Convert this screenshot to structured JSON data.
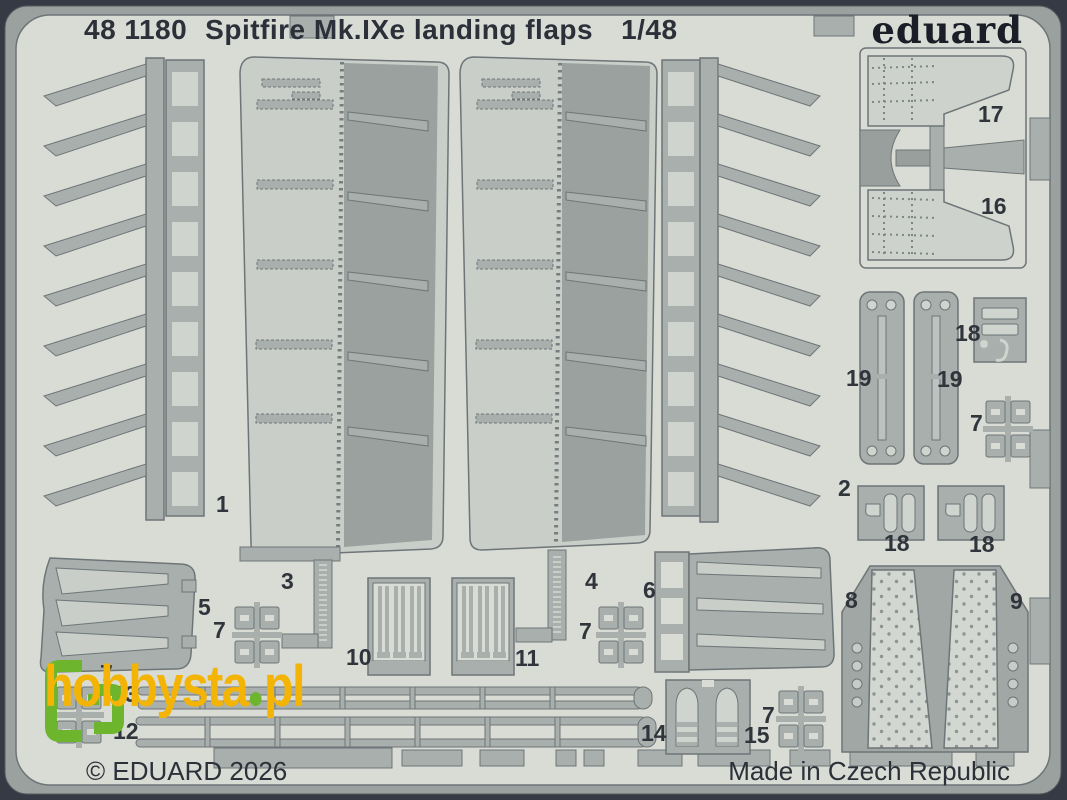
{
  "header": {
    "catalog_number": "48 1180",
    "product_name": "Spitfire Mk.IXe landing flaps",
    "scale": "1/48"
  },
  "brand": {
    "logo_text": "eduard"
  },
  "footer": {
    "copyright": "© EDUARD 2026",
    "origin": "Made in Czech Republic"
  },
  "watermark": {
    "site_name": "hobbysta",
    "separator": ".",
    "tld": "pl"
  },
  "part_labels": [
    "1",
    "2",
    "3",
    "4",
    "5",
    "6",
    "7",
    "7",
    "7",
    "7",
    "7",
    "8",
    "9",
    "10",
    "11",
    "12",
    "13",
    "14",
    "15",
    "16",
    "17",
    "18",
    "18",
    "18",
    "19",
    "19"
  ],
  "colors": {
    "border_dark": "#363a44",
    "frame_band": "#9aa19e",
    "fret_surface": "#d9dcd5",
    "part_metal": "#a8afac",
    "part_light": "#ccd1cb",
    "part_dark": "#989f9c",
    "outline": "#6e7578",
    "text_dark": "#2c3039",
    "watermark_yellow": "#f3b406",
    "watermark_green": "#6cb52d"
  }
}
